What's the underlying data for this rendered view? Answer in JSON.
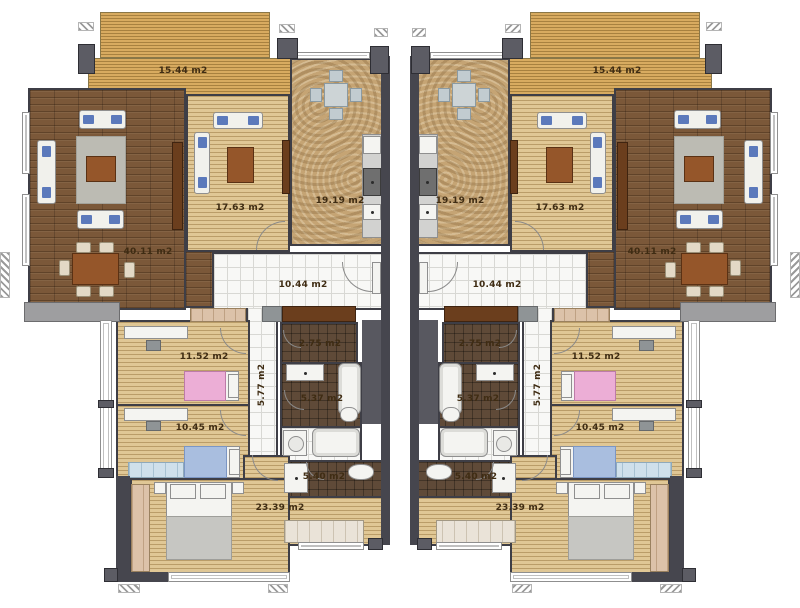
{
  "floorplan": {
    "units": [
      {
        "id": "left-unit",
        "rooms": {
          "terrace": {
            "area": "15.44 m2"
          },
          "living": {
            "area": "40.11 m2"
          },
          "lounge": {
            "area": "17.63 m2"
          },
          "kitchen": {
            "area": "19.19 m2"
          },
          "hall": {
            "area": "10.44 m2"
          },
          "corridor": {
            "area": "5.77 m2"
          },
          "wc": {
            "area": "2.75 m2"
          },
          "bath_a": {
            "area": "5.37 m2"
          },
          "bath_b": {
            "area": "5.40 m2"
          },
          "bedroom_a": {
            "area": "11.52 m2"
          },
          "bedroom_b": {
            "area": "10.45 m2"
          },
          "master": {
            "area": "23.39 m2"
          }
        }
      },
      {
        "id": "right-unit",
        "rooms": {
          "terrace": {
            "area": "15.44 m2"
          },
          "living": {
            "area": "40.11 m2"
          },
          "lounge": {
            "area": "17.63 m2"
          },
          "kitchen": {
            "area": "19.19 m2"
          },
          "hall": {
            "area": "10.44 m2"
          },
          "corridor": {
            "area": "5.77 m2"
          },
          "wc": {
            "area": "2.75 m2"
          },
          "bath_a": {
            "area": "5.37 m2"
          },
          "bath_b": {
            "area": "5.40 m2"
          },
          "bedroom_a": {
            "area": "11.52 m2"
          },
          "bedroom_b": {
            "area": "10.45 m2"
          },
          "master": {
            "area": "23.39 m2"
          }
        }
      }
    ],
    "colors": {
      "wall": "#46464e",
      "dark_wood_floor": "#7b5839",
      "light_wood_floor": "#e0c795",
      "deck": "#d8ab60",
      "marble": "#c5a474",
      "dark_tile": "#5f4a38",
      "white_tile": "#f8f8f6",
      "balcony": "#9e9ea0",
      "pink_bed": "#ecaed6",
      "blue_bed": "#a9bedf",
      "label_text": "#3f2c13"
    }
  }
}
